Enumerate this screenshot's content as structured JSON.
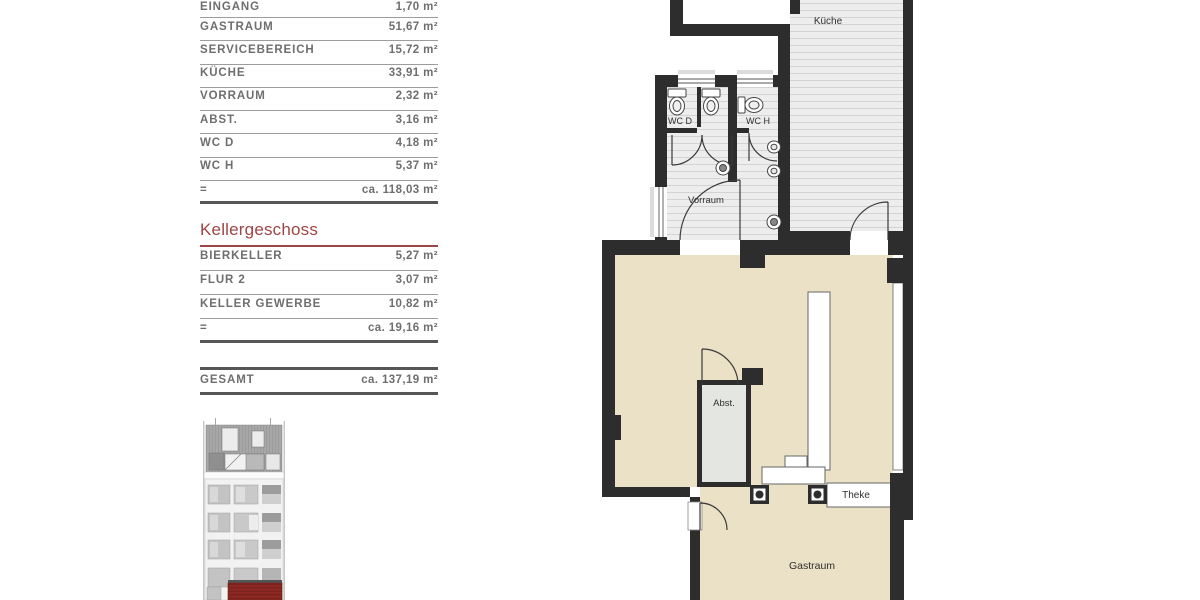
{
  "colors": {
    "accent_red": "#9e4545",
    "wall": "#2d2d2d",
    "floor_beige": "#ebe1c6",
    "elevation_red": "#8d2823"
  },
  "upper_table": {
    "rows": [
      {
        "label": "EINGANG",
        "value": "1,70 m²"
      },
      {
        "label": "GASTRAUM",
        "value": "51,67 m²"
      },
      {
        "label": "SERVICEBEREICH",
        "value": "15,72 m²"
      },
      {
        "label": "KÜCHE",
        "value": "33,91 m²"
      },
      {
        "label": "VORRAUM",
        "value": "2,32 m²"
      },
      {
        "label": "ABST.",
        "value": "3,16 m²"
      },
      {
        "label": "WC D",
        "value": "4,18 m²"
      },
      {
        "label": "WC H",
        "value": "5,37 m²"
      },
      {
        "label": "=",
        "value": "ca. 118,03 m²"
      }
    ]
  },
  "basement_table": {
    "heading": "Kellergeschoss",
    "rows": [
      {
        "label": "BIERKELLER",
        "value": "5,27 m²"
      },
      {
        "label": "FLUR 2",
        "value": "3,07 m²"
      },
      {
        "label": "KELLER GEWERBE",
        "value": "10,82 m²"
      },
      {
        "label": "=",
        "value": "ca. 19,16 m²"
      }
    ]
  },
  "total_row": {
    "label": "GESAMT",
    "value": "ca. 137,19 m²"
  },
  "floor_plan": {
    "room_labels": {
      "kueche": "Küche",
      "wc_d": "WC D",
      "wc_h": "WC H",
      "vorraum": "Vorraum",
      "abst": "Abst.",
      "theke": "Theke",
      "gastraum": "Gastraum"
    }
  }
}
